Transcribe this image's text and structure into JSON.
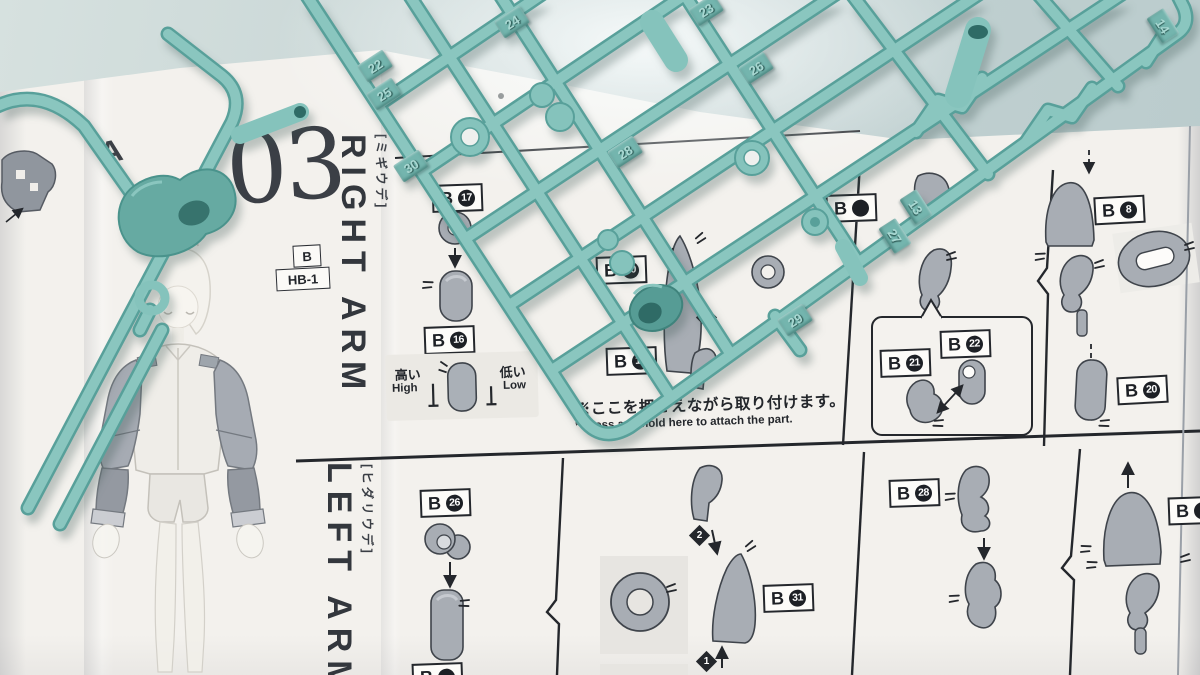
{
  "manual": {
    "section_number": "03",
    "prev_section_letter": "A",
    "right_arm": {
      "title_en": "RIGHT ARM",
      "title_ja": "[ミギウデ]"
    },
    "left_arm": {
      "title_en": "LEFT ARM",
      "title_ja": "[ヒダリウデ]"
    },
    "runner_badge": "B",
    "runner_code": "HB-1",
    "height_note": {
      "high_ja": "高い",
      "high_en": "High",
      "low_ja": "低い",
      "low_en": "Low"
    },
    "press_note": {
      "ja": "※ここを押さえながら取り付けます。",
      "en": "* Press and hold here to attach the part."
    },
    "part_labels": [
      {
        "prefix": "B",
        "number": "17"
      },
      {
        "prefix": "B",
        "number": "16"
      },
      {
        "prefix": "B",
        "number": "30"
      },
      {
        "prefix": "B",
        "number": "18"
      },
      {
        "prefix": "B",
        "number": "21"
      },
      {
        "prefix": "B",
        "number": "22"
      },
      {
        "prefix": "B",
        "number": "8"
      },
      {
        "prefix": "B",
        "number": "20"
      },
      {
        "prefix": "B",
        "number": "26"
      },
      {
        "prefix": "B",
        "number": "31"
      },
      {
        "prefix": "B",
        "number": "28"
      },
      {
        "prefix": "B",
        "number": ""
      },
      {
        "prefix": "B",
        "number": ""
      },
      {
        "prefix": "B",
        "number": ""
      }
    ],
    "steps": {
      "one": "1",
      "two": "2"
    }
  },
  "sprue": {
    "tags": [
      "22",
      "25",
      "30",
      "24",
      "23",
      "26",
      "28",
      "29",
      "27",
      "13",
      "14"
    ]
  },
  "colors": {
    "sprue_teal": "#85c3bc",
    "sprue_dark": "#5ca39b",
    "paper": "#f3f1ed",
    "table": "#c6d4d4",
    "print": "#2a2d33",
    "part_grey": "#a8adb4"
  }
}
